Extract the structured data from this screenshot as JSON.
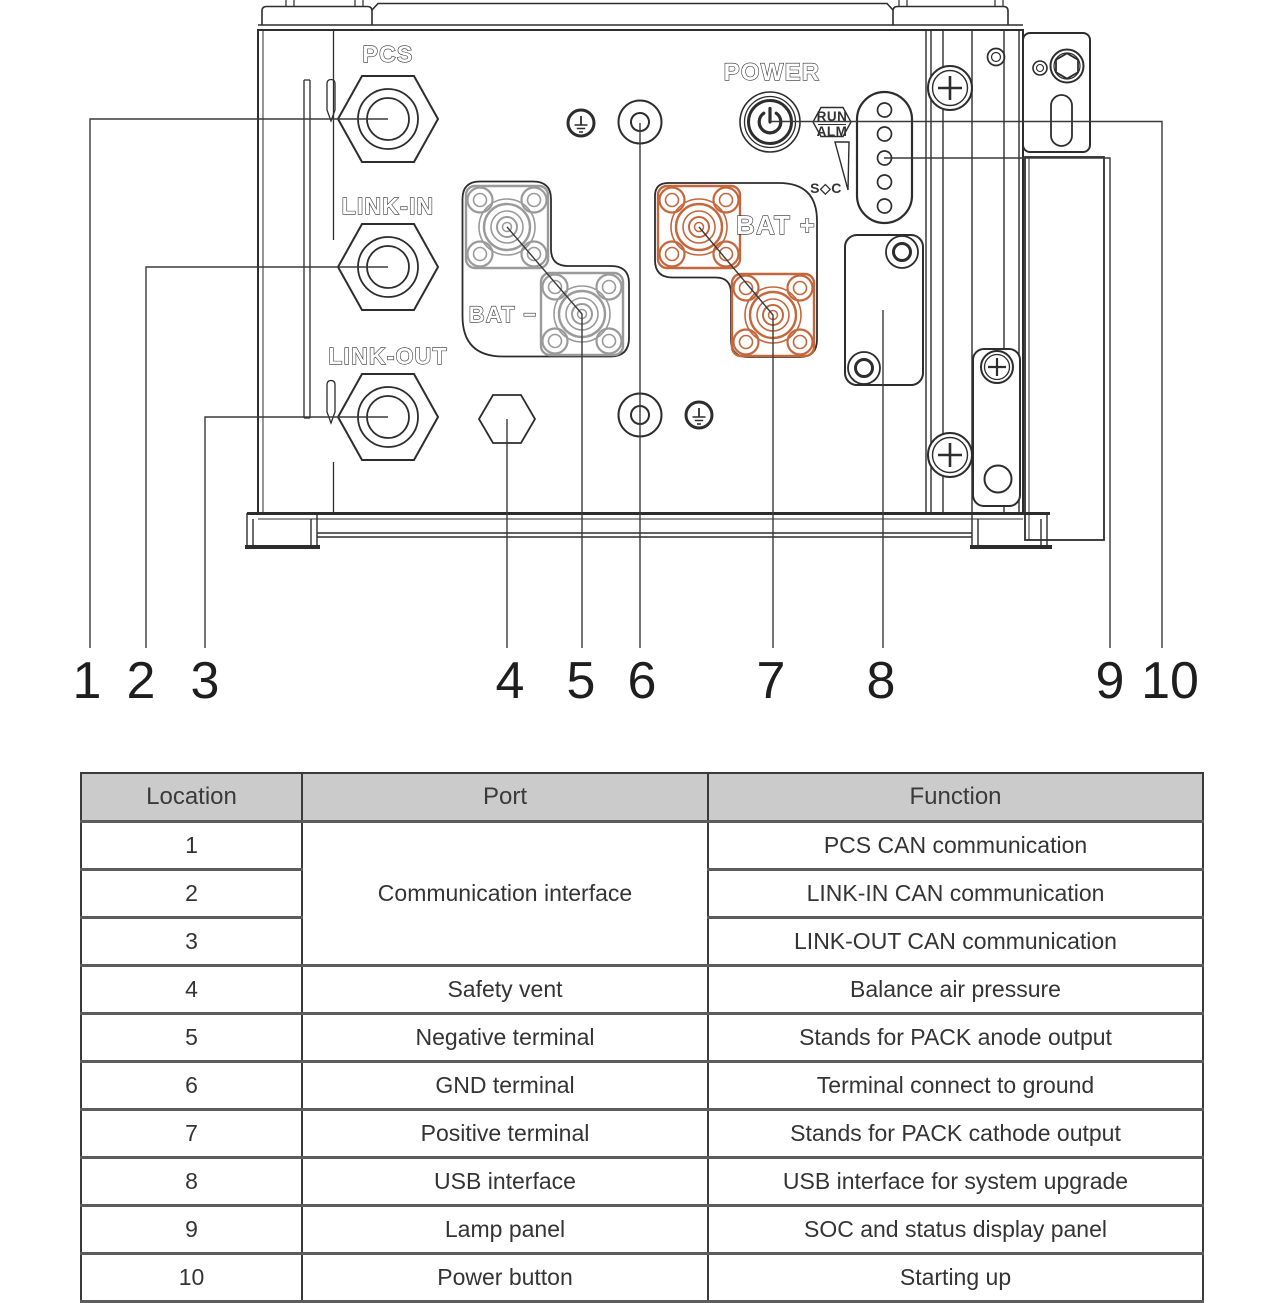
{
  "colors": {
    "bat_plus_orange": "#c4673c",
    "bat_minus_gray": "#9a9a9a",
    "drawing_line": "#2d2d2d",
    "table_header_bg": "#cbcbcb",
    "table_border_dark": "#3a3a3a",
    "table_border_gray": "#5c5c5c"
  },
  "diagram": {
    "labels": {
      "pcs": "PCS",
      "link_in": "LINK-IN",
      "link_out": "LINK-OUT",
      "power": "POWER",
      "run": "RUN",
      "alm": "ALM",
      "soc": "S◇C",
      "bat_minus": "BAT −",
      "bat_plus": "BAT +"
    },
    "callouts": [
      "1",
      "2",
      "3",
      "4",
      "5",
      "6",
      "7",
      "8",
      "9",
      "10"
    ]
  },
  "table": {
    "headers": [
      "Location",
      "Port",
      "Function"
    ],
    "merged_port": "Communication interface",
    "rows": [
      {
        "location": "1",
        "port": "",
        "function": "PCS CAN communication"
      },
      {
        "location": "2",
        "port": "",
        "function": "LINK-IN CAN communication"
      },
      {
        "location": "3",
        "port": "",
        "function": "LINK-OUT CAN communication"
      },
      {
        "location": "4",
        "port": "Safety vent",
        "function": "Balance air pressure"
      },
      {
        "location": "5",
        "port": "Negative terminal",
        "function": "Stands for PACK anode output"
      },
      {
        "location": "6",
        "port": "GND terminal",
        "function": "Terminal connect to ground"
      },
      {
        "location": "7",
        "port": "Positive terminal",
        "function": "Stands for PACK cathode output"
      },
      {
        "location": "8",
        "port": "USB interface",
        "function": "USB interface for system upgrade"
      },
      {
        "location": "9",
        "port": "Lamp panel",
        "function": "SOC and status display panel"
      },
      {
        "location": "10",
        "port": "Power button",
        "function": "Starting up"
      }
    ]
  }
}
